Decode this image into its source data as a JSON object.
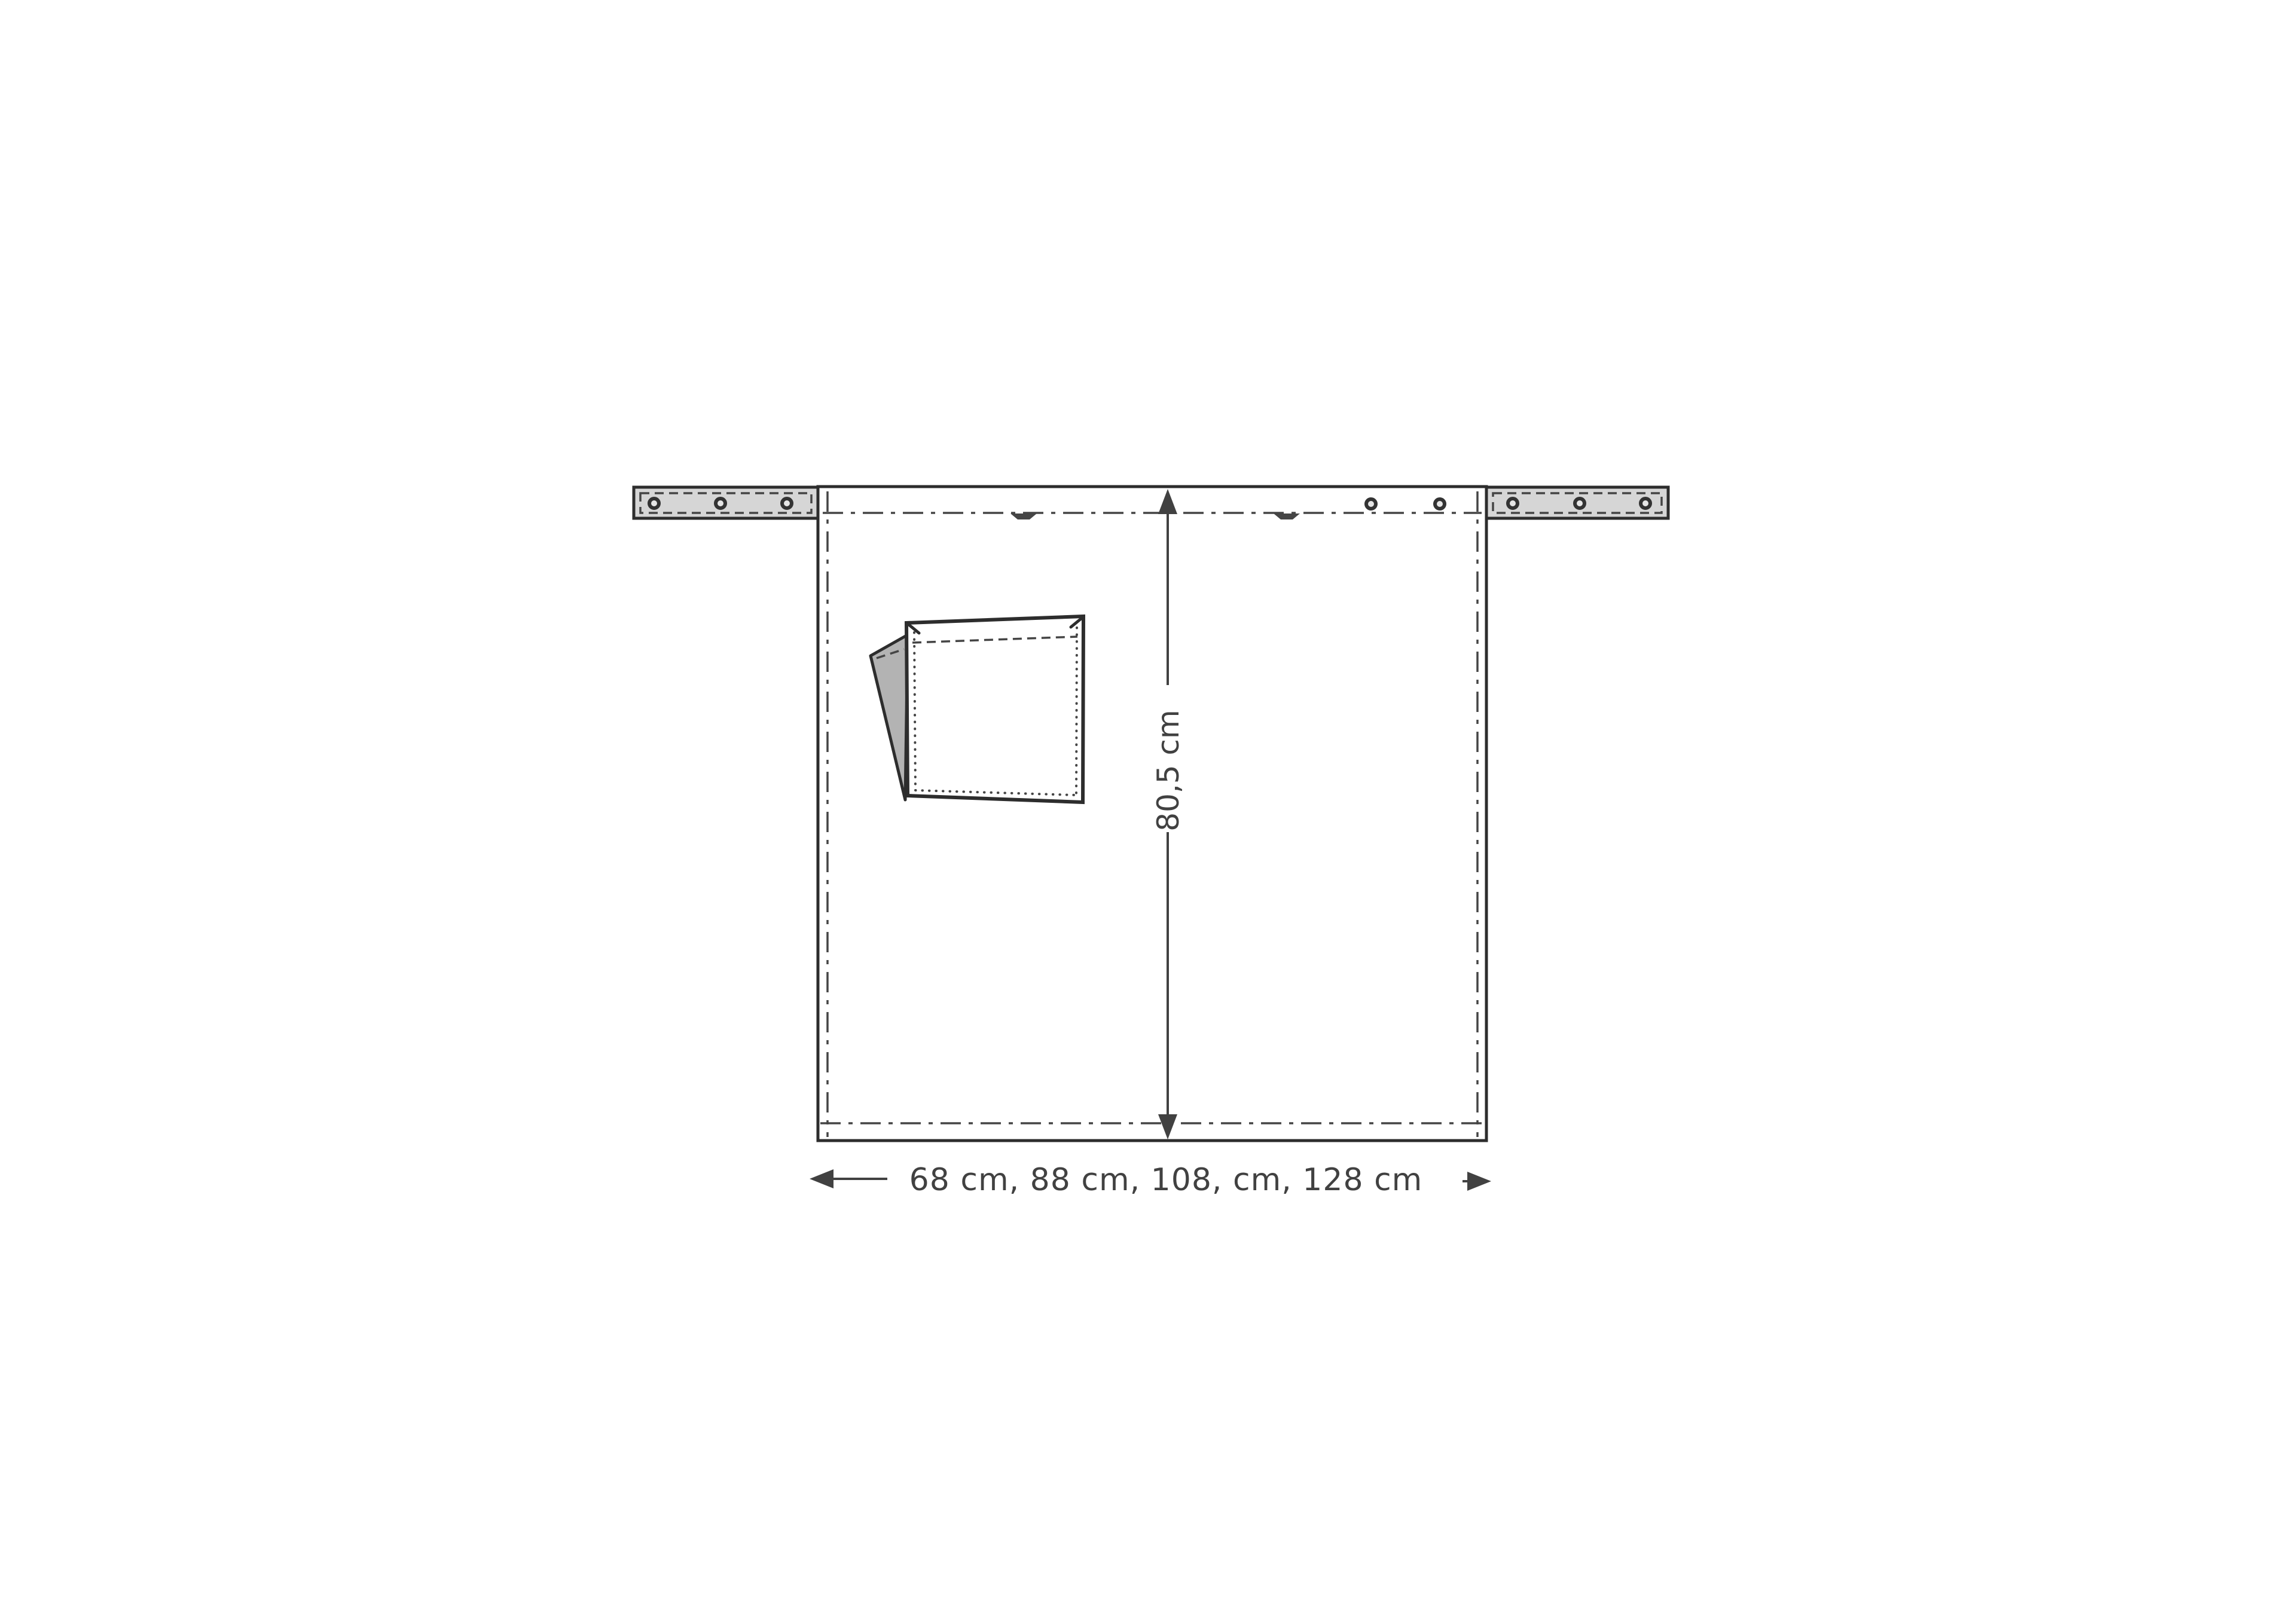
{
  "diagram": {
    "labels": {
      "height": "80,5 cm",
      "widths": "68 cm, 88 cm, 108, cm, 128 cm"
    },
    "colors": {
      "background": "#ffffff",
      "line": "#2d2d2d",
      "stitch": "#454545",
      "dimension": "#414141",
      "strap_fill": "#d6d6d6",
      "flap_fill": "#b3b3b3",
      "rivet_ring": "#333333",
      "rivet_center": "#e6e6e6"
    },
    "icons": {
      "up_arrow": "↑",
      "down_arrow": "↓",
      "left_arrow": "←",
      "right_arrow": "→",
      "rivet": "◉",
      "notch": "▾"
    }
  }
}
